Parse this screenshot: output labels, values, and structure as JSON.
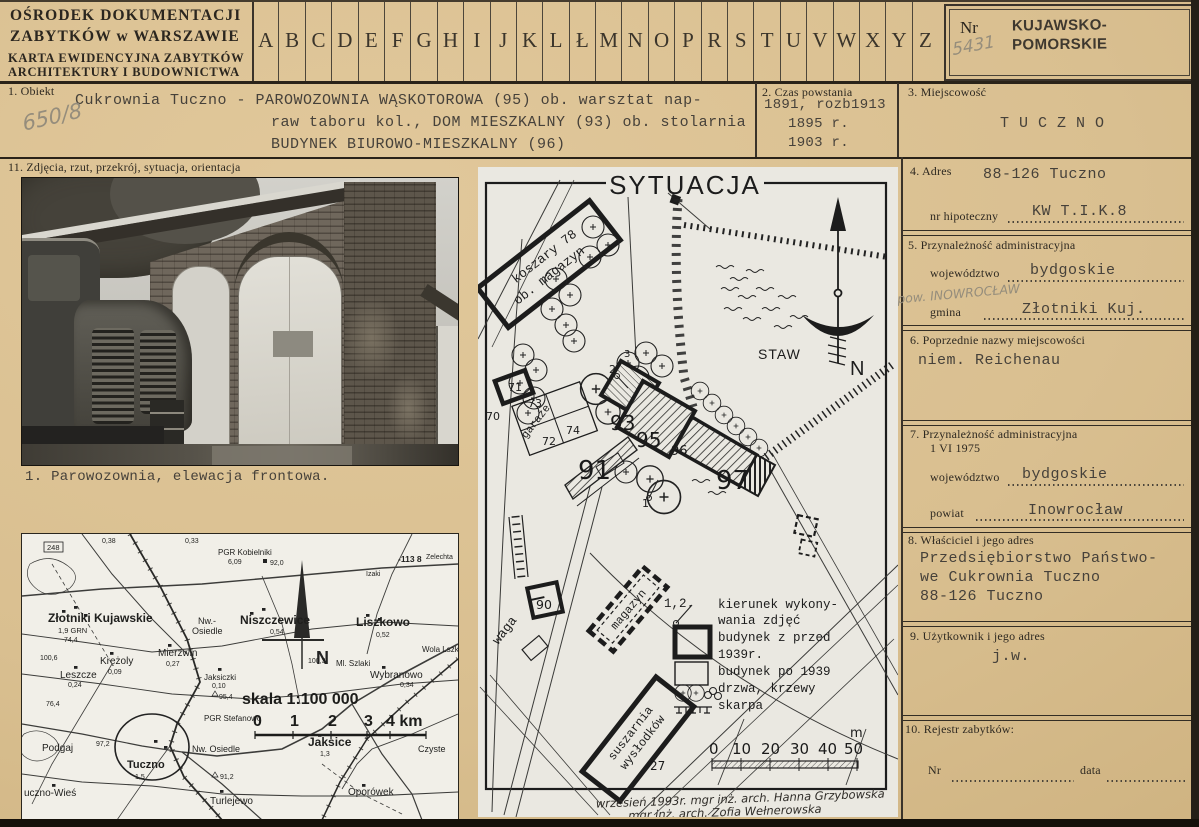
{
  "colors": {
    "paper": "#d9bf90",
    "ink": "#2e2921",
    "typewriter": "#46413a",
    "plan_paper": "#eae8e1",
    "pencil": "#958d7c"
  },
  "header": {
    "org_line1": "OŚRODEK DOKUMENTACJI",
    "org_line2": "ZABYTKÓW w WARSZAWIE",
    "card_line1": "KARTA EWIDENCYJNA ZABYTKÓW",
    "card_line2": "ARCHITEKTURY I BUDOWNICTWA",
    "alphabet": [
      "A",
      "B",
      "C",
      "D",
      "E",
      "F",
      "G",
      "H",
      "I",
      "J",
      "K",
      "L",
      "Ł",
      "M",
      "N",
      "O",
      "P",
      "R",
      "S",
      "T",
      "U",
      "V",
      "W",
      "X",
      "Y",
      "Z"
    ],
    "nr_label": "Nr",
    "nr_value": "5431",
    "stamp_line1": "KUJAWSKO-",
    "stamp_line2": "POMORSKIE"
  },
  "handwritten": {
    "archive_no": "650/8",
    "pow_note": "pow. INOWROCŁAW"
  },
  "sections": {
    "s1": {
      "label": "1. Obiekt",
      "line1": "Cukrownia Tuczno - PAROWOZOWNIA WĄSKOTOROWA (95) ob. warsztat nap-",
      "line2": "raw taboru kol., DOM MIESZKALNY (93) ob. stolarnia",
      "line3": "BUDYNEK BIUROWO-MIESZKALNY (96)"
    },
    "s2": {
      "label": "2. Czas powstania",
      "line1": "1891, rozb1913",
      "line2": "1895 r.",
      "line3": "1903 r."
    },
    "s3": {
      "label": "3. Miejscowość",
      "value": "T U C Z N O"
    },
    "s4": {
      "label": "4. Adres",
      "value": "88-126 Tuczno",
      "field_label": "nr hipoteczny",
      "field_value": "KW T.I.K.8"
    },
    "s5": {
      "label": "5. Przynależność administracyjna",
      "f1_label": "województwo",
      "f1_value": "bydgoskie",
      "f2_label": "gmina",
      "f2_value": "Złotniki Kuj."
    },
    "s6": {
      "label": "6. Poprzednie nazwy miejscowości",
      "value": "niem. Reichenau"
    },
    "s7": {
      "label": "7. Przynależność administracyjna",
      "label2": "1 VI 1975",
      "f1_label": "województwo",
      "f1_value": "bydgoskie",
      "f2_label": "powiat",
      "f2_value": "Inowrocław"
    },
    "s8": {
      "label": "8. Właściciel i jego adres",
      "line1": "Przedsiębiorstwo Państwo-",
      "line2": "we Cukrownia Tuczno",
      "line3": "88-126 Tuczno"
    },
    "s9": {
      "label": "9. Użytkownik i jego adres",
      "value": "j.w."
    },
    "s10": {
      "label": "10. Rejestr zabytków:",
      "nr_label": "Nr",
      "data_label": "data"
    },
    "s11": {
      "label": "11. Zdjęcia, rzut, przekrój, sytuacja, orientacja"
    }
  },
  "photo": {
    "caption": "1. Parowozownia, elewacja frontowa."
  },
  "siteplan": {
    "title": "SYTUACJA",
    "labels": {
      "koszary": "koszary 78",
      "ob_magazyn": "ob. magazyn",
      "staw": "STAW",
      "n": "N",
      "waga": "waga",
      "garaze": "garaże",
      "magazyn": "magazyn",
      "suszarnia1": "suszarnia",
      "suszarnia2": "wysłodków"
    },
    "numbers": {
      "b70": "70",
      "b71": "71",
      "b72": "72",
      "b73": "73",
      "b74": "74",
      "b90": "90",
      "b91": "91",
      "b93": "93",
      "b95": "95",
      "b96": "96",
      "b97": "97",
      "b27": "27",
      "p1": "1",
      "p2": "2",
      "p3": "3"
    },
    "legend": {
      "photos_label": "1,2.",
      "l1a": "kierunek wykony-",
      "l1b": "wania zdjęć",
      "l2a": "budynek z przed",
      "l2b": "1939r.",
      "l3": "budynek po 1939",
      "l4": "drzwa, krzewy",
      "l5": "skarpa"
    },
    "scale": {
      "n0": "0",
      "n10": "10",
      "n20": "20",
      "n30": "30",
      "n40": "40",
      "n50": "50",
      "unit": "m"
    },
    "note1": "wrzesień 1993r.  mgr inż. arch. Hanna Grzybowska",
    "note2": "mgr inż. arch. Zofia Wełnerowska"
  },
  "topomap": {
    "scale_label": "skala 1:100 000",
    "scale": {
      "n0": "0",
      "n1": "1",
      "n2": "2",
      "n3": "3",
      "n4": "4 km"
    },
    "compass": "N",
    "places": {
      "zlotniki": "Złotniki Kujawskie",
      "grn": "1,9 GRN",
      "h744": "74,4",
      "road248": "248",
      "pgr_kobielniki": "PGR Kobielniki",
      "h609": "6,09",
      "h920": "92,0",
      "h038": "0,38",
      "h033": "0,33",
      "zelechta": "Zelechta",
      "niszczewice": "Niszczewice",
      "h054": "0,54",
      "krezoly": "Krężoly",
      "h009": "0,09",
      "nwo1a": "Nw.-",
      "nwo1b": "Osiedle",
      "h113": "-113 8",
      "izaki": "Izaki",
      "liszkowo": "Liszkowo",
      "h052": "0,52",
      "mierzwin": "Mierzwin",
      "h027": "0,27",
      "h1006": "100,6",
      "leszcze": "Leszcze",
      "h024": "0,24",
      "ml_szlaki": "Ml. Szlaki",
      "h1003": "100,3",
      "wola": "Wola Lszko",
      "wybranowo": "Wybranowo",
      "h034": "0,34",
      "jaksiczki": "Jaksiczki",
      "h010": "0,10",
      "h954": "95,4",
      "h764": "76,4",
      "pgr_stefanowo": "PGR Stefanowo",
      "jaksice": "Jaksice",
      "h13": "1,3",
      "nwo2": "Nw. Osiedle",
      "podgaj": "Podgaj",
      "h972": "97,2",
      "tuczno": "Tuczno",
      "h15": "1,5",
      "h912": "91,2",
      "tuczno_wies": "uczno-Wieś",
      "turlejewo": "Turlejewo",
      "oporowek": "Oporówek",
      "czyste": "Czyste"
    }
  }
}
